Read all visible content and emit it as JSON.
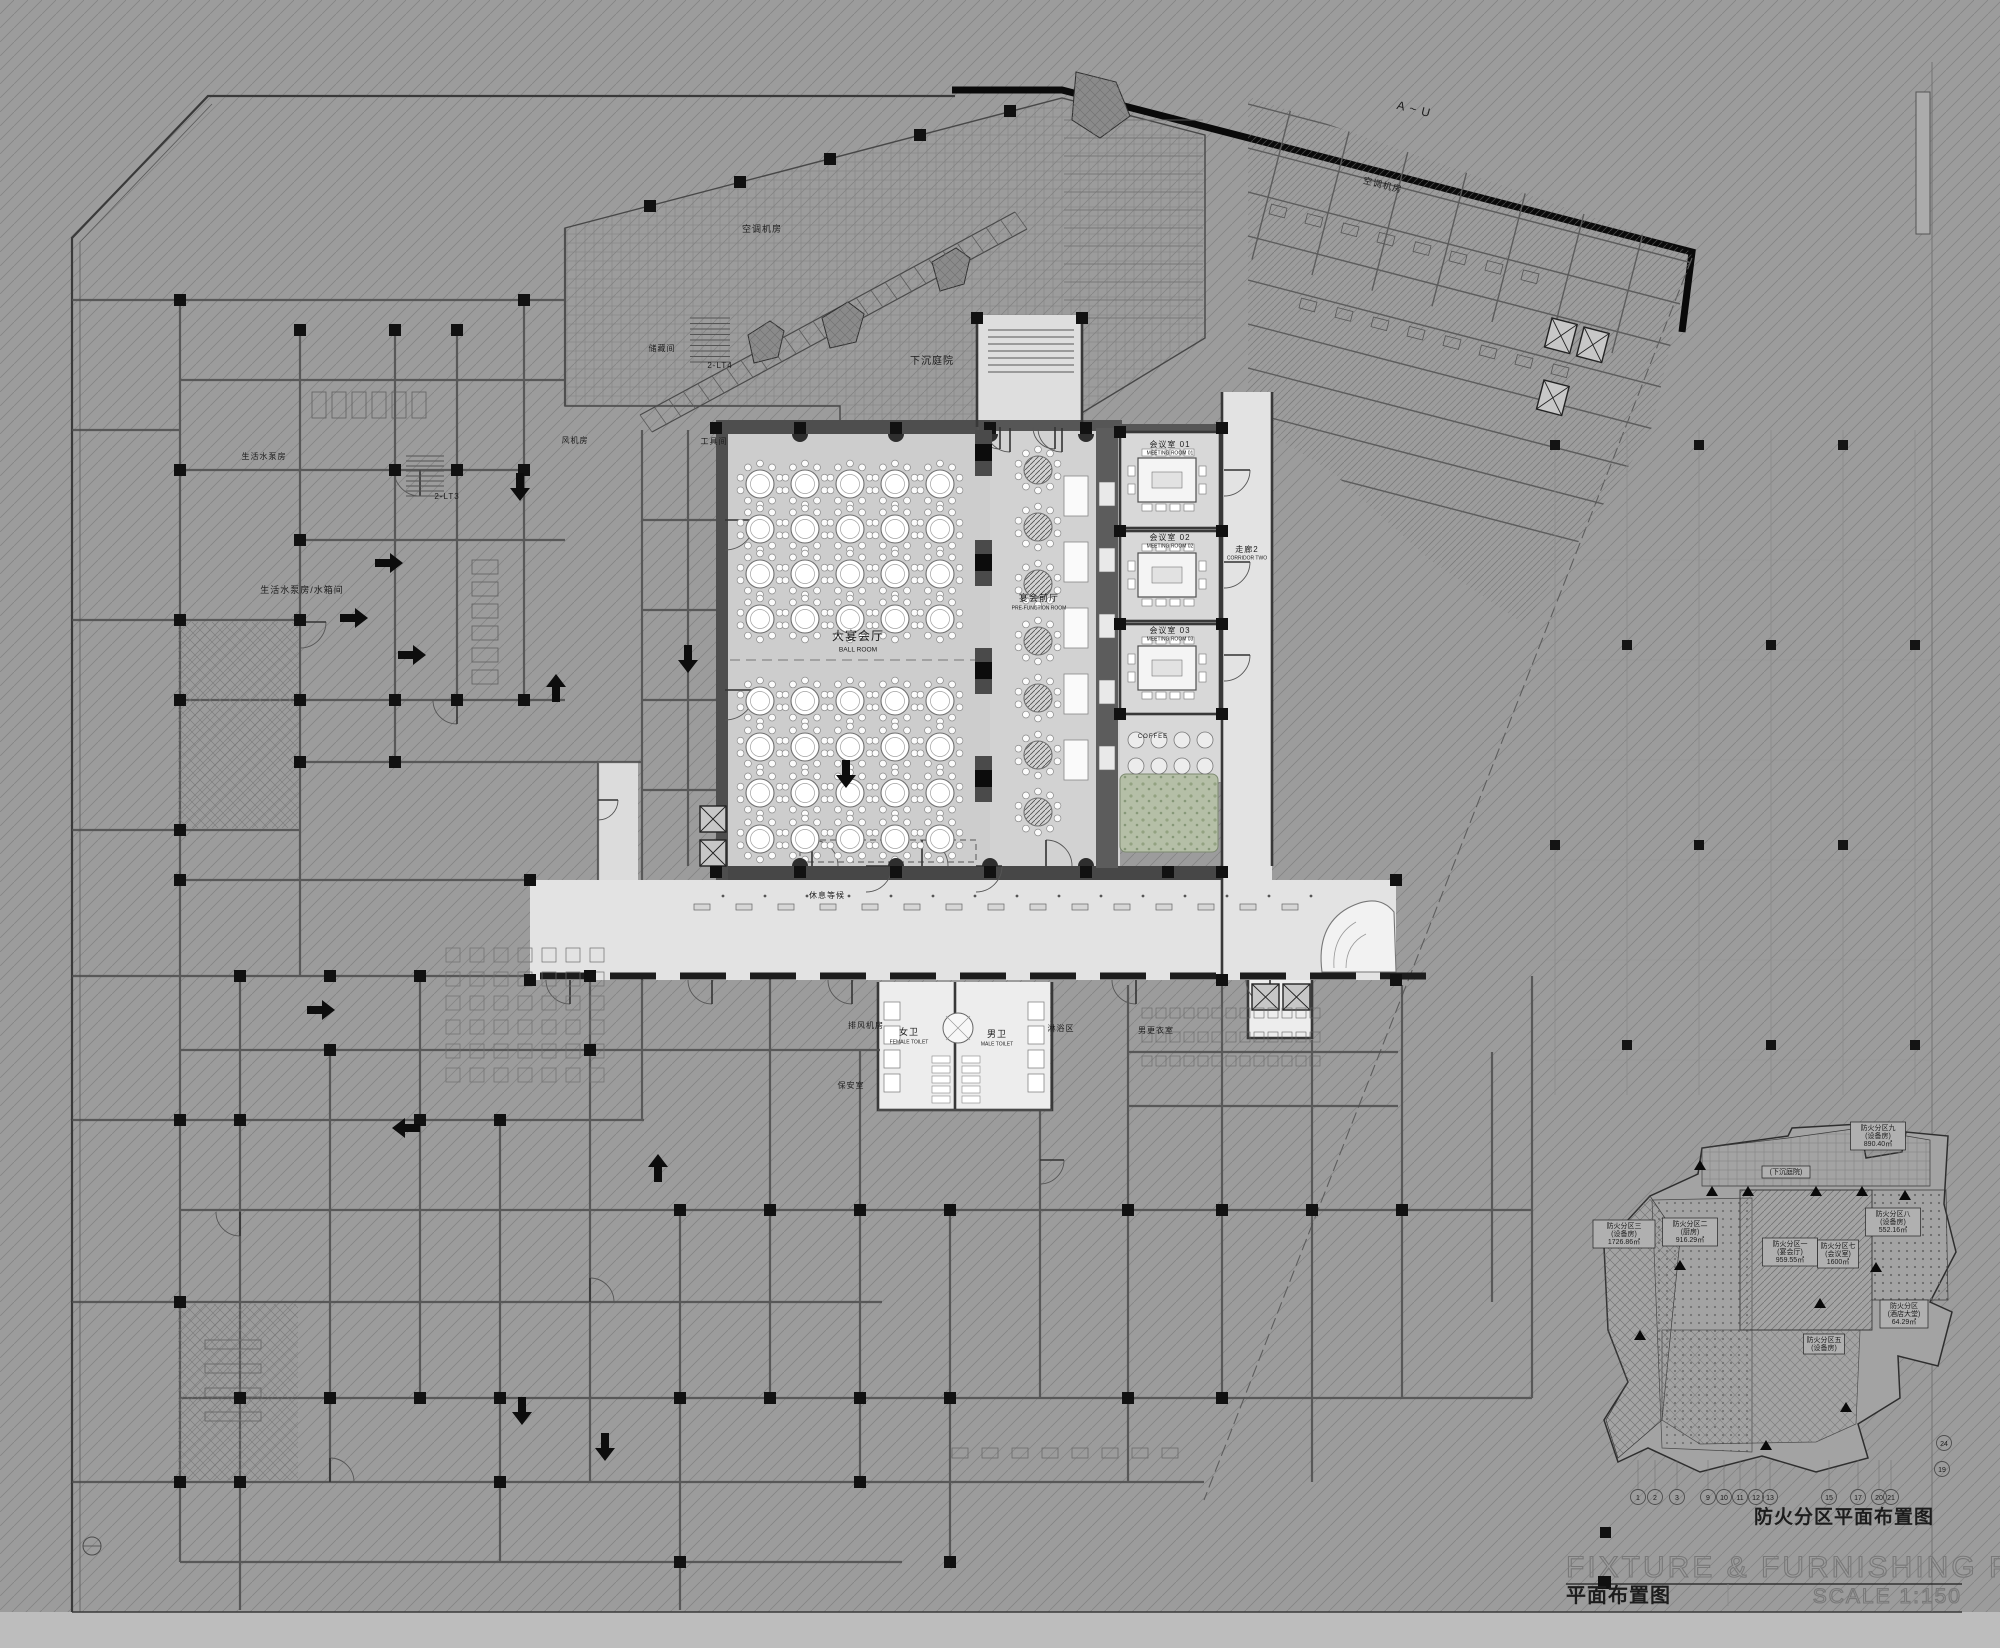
{
  "title_block": {
    "watermark": "FIXTURE & FURNISHING PLAN",
    "scale": "SCALE 1:150",
    "plan_title": "平面布置图",
    "fire_plan_title": "防火分区平面布置图"
  },
  "rooms": [
    {
      "t": "大宴会厅",
      "e": "BALL ROOM",
      "x": 858,
      "y": 640,
      "s": 12
    },
    {
      "t": "宴会前厅",
      "e": "PRE-FUNCTION ROOM",
      "x": 1039,
      "y": 601,
      "s": 9
    },
    {
      "t": "会议室 01",
      "e": "MEETING ROOM 01",
      "x": 1170,
      "y": 447,
      "s": 8
    },
    {
      "t": "会议室 02",
      "e": "MEETING ROOM 02",
      "x": 1170,
      "y": 540,
      "s": 8
    },
    {
      "t": "会议室 03",
      "e": "MEETING ROOM 03",
      "x": 1170,
      "y": 633,
      "s": 8
    },
    {
      "t": "走廊2",
      "e": "CORRIDOR TWO",
      "x": 1247,
      "y": 552,
      "s": 8
    },
    {
      "t": "下沉庭院",
      "x": 932,
      "y": 364,
      "s": 10
    },
    {
      "t": "空调机房",
      "x": 762,
      "y": 232,
      "s": 9
    },
    {
      "t": "空调机房",
      "x": 1382,
      "y": 188,
      "s": 9,
      "r": 14
    },
    {
      "t": "风机房",
      "x": 575,
      "y": 443,
      "s": 8
    },
    {
      "t": "工具间",
      "x": 714,
      "y": 444,
      "s": 8
    },
    {
      "t": "储藏间",
      "x": 662,
      "y": 351,
      "s": 8
    },
    {
      "t": "生活水泵房",
      "x": 264,
      "y": 459,
      "s": 8
    },
    {
      "t": "生活水泵房/水箱间",
      "x": 302,
      "y": 593,
      "s": 9
    },
    {
      "t": "排风机房",
      "x": 866,
      "y": 1028,
      "s": 8
    },
    {
      "t": "保安室",
      "x": 851,
      "y": 1088,
      "s": 8
    },
    {
      "t": "女卫",
      "e": "FEMALE TOILET",
      "x": 909,
      "y": 1035,
      "s": 9
    },
    {
      "t": "男卫",
      "e": "MALE TOILET",
      "x": 997,
      "y": 1037,
      "s": 9
    },
    {
      "t": "淋浴区",
      "x": 1061,
      "y": 1031,
      "s": 8
    },
    {
      "t": "男更衣室",
      "x": 1156,
      "y": 1033,
      "s": 8
    },
    {
      "t": "休息等候",
      "x": 827,
      "y": 898,
      "s": 8
    },
    {
      "t": "2-LT4",
      "x": 720,
      "y": 368,
      "s": 8
    },
    {
      "t": "2-LT3",
      "x": 447,
      "y": 499,
      "s": 8
    },
    {
      "t": "A ~ U",
      "x": 1413,
      "y": 113,
      "s": 12,
      "r": 14
    },
    {
      "t": "COFFEE",
      "x": 1153,
      "y": 738,
      "s": 6
    }
  ],
  "fire_zones": [
    {
      "name": "防火分区一",
      "use": "(宴会厅)",
      "area": "959.55㎡",
      "x": 1790,
      "y": 1246
    },
    {
      "name": "防火分区二",
      "use": "(厨房)",
      "area": "916.29㎡",
      "x": 1690,
      "y": 1226
    },
    {
      "name": "防火分区三",
      "use": "(设备房)",
      "area": "1726.86㎡",
      "x": 1624,
      "y": 1228
    },
    {
      "name": "防火分区五",
      "use": "(设备房)",
      "area": "",
      "x": 1824,
      "y": 1342
    },
    {
      "name": "防火分区七",
      "use": "(会议室)",
      "area": "1600㎡",
      "x": 1838,
      "y": 1248
    },
    {
      "name": "防火分区八",
      "use": "(设备房)",
      "area": "552.16㎡",
      "x": 1893,
      "y": 1216
    },
    {
      "name": "防火分区九",
      "use": "(设备房)",
      "area": "890.40㎡",
      "x": 1878,
      "y": 1130
    },
    {
      "name": "防火分区",
      "use": "(酒店大堂)",
      "area": "64.29㎡",
      "x": 1904,
      "y": 1308
    },
    {
      "name": "(下沉庭院)",
      "use": "",
      "area": "",
      "x": 1786,
      "y": 1174
    }
  ],
  "grid_bubbles": [
    {
      "n": "1",
      "x": 1638
    },
    {
      "n": "2",
      "x": 1655
    },
    {
      "n": "3",
      "x": 1677
    },
    {
      "n": "9",
      "x": 1708
    },
    {
      "n": "10",
      "x": 1724
    },
    {
      "n": "11",
      "x": 1740
    },
    {
      "n": "12",
      "x": 1756
    },
    {
      "n": "13",
      "x": 1770
    },
    {
      "n": "15",
      "x": 1829
    },
    {
      "n": "17",
      "x": 1858
    },
    {
      "n": "20",
      "x": 1879
    },
    {
      "n": "21",
      "x": 1891
    }
  ],
  "side_bubbles": [
    {
      "n": "24",
      "x": 1944,
      "y": 1443
    },
    {
      "n": "19",
      "x": 1942,
      "y": 1469
    }
  ]
}
